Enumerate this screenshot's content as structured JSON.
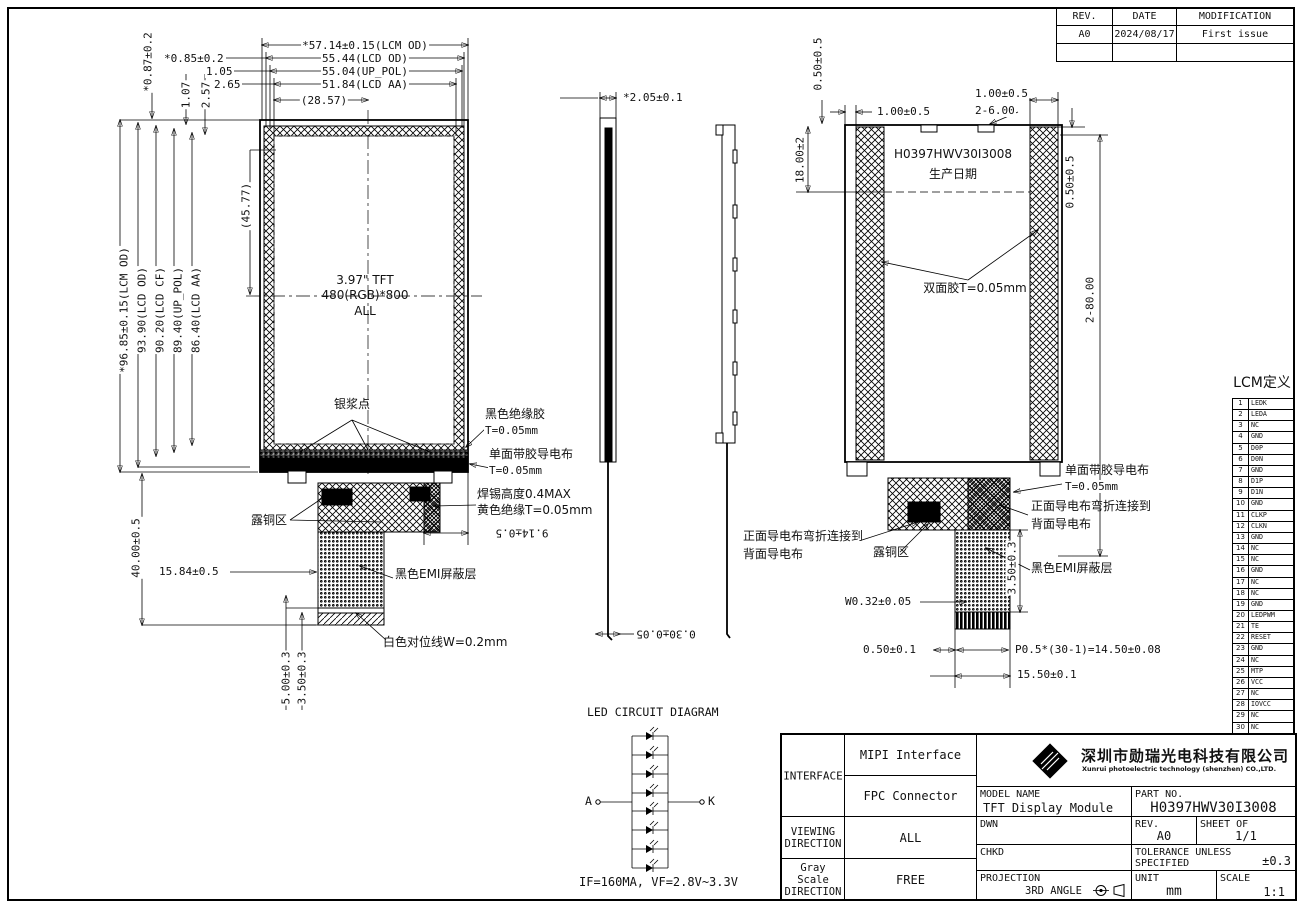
{
  "rev_table": {
    "col_rev": "REV.",
    "col_date": "DATE",
    "col_mod": "MODIFICATION",
    "rev": "A0",
    "date": "2024/08/17",
    "mod": "First issue"
  },
  "front_view": {
    "dims": {
      "w_lcm": "*57.14±0.15(LCM OD)",
      "w_lcd": "55.44(LCD OD)",
      "w_pol": "55.04(UP_POL)",
      "w_aa": "51.84(LCD AA)",
      "w_half": "(28.57)",
      "off1": "*0.85±0.2",
      "off2": "1.05",
      "off3": "2.65",
      "voff1": "*0.87±0.2",
      "voff2": "1.07",
      "voff3": "2.57",
      "h_lcm": "*96.85±0.15(LCM OD)",
      "h_lcd": "93.90(LCD OD)",
      "h_cf": "90.20(LCD CF)",
      "h_pol": "89.40(UP_POL)",
      "h_aa": "86.40(LCD AA)",
      "h_half": "(45.77)",
      "fpc_len": "40.00±0.5",
      "fpc_off": "15.84±0.5",
      "fpc_w": "9.14±0.5",
      "tail_a": "5.00±0.3",
      "tail_b": "3.50±0.3"
    },
    "screen": {
      "line1": "3.97\" TFT",
      "line2": "480(RGB)*800",
      "line3": "ALL"
    },
    "labels": {
      "silver": "银浆点",
      "glue1": "黑色绝缘胶",
      "glue2": "T=0.05mm",
      "cloth1": "单面带胶导电布",
      "cloth2": "T=0.05mm",
      "solder1": "焊锡高度0.4MAX",
      "solder2": "黄色绝缘T=0.05mm",
      "copper": "露铜区",
      "emi": "黑色EMI屏蔽层",
      "align": "白色对位线W=0.2mm"
    }
  },
  "side_view": {
    "thickness": "*2.05±0.1",
    "fpc_t": "0.30±0.05"
  },
  "rear_view": {
    "dims": {
      "gap_tl": "0.50±0.5",
      "tape_l": "1.00±0.5",
      "tape_r": "1.00±0.5",
      "notch": "2-6.00",
      "date_h": "18.00±2",
      "gap_tr": "0.50±0.5",
      "tape_len": "2-80.00",
      "emi_h": "3.50±0.3",
      "trace": "W0.32±0.05",
      "pad": "0.50±0.1",
      "pitch": "P0.5*(30-1)=14.50±0.08",
      "fpc_w": "15.50±0.1"
    },
    "marking": {
      "part": "H0397HWV30I3008",
      "date": "生产日期"
    },
    "labels": {
      "tape": "双面胶T=0.05mm",
      "cloth1": "单面带胶导电布",
      "cloth2": "T=0.05mm",
      "fold1a": "正面导电布弯折连接到",
      "fold1b": "背面导电布",
      "fold2a": "正面导电布弯折连接到",
      "fold2b": "背面导电布",
      "copper": "露铜区",
      "emi": "黑色EMI屏蔽层"
    }
  },
  "pin_table": {
    "title": "LCM定义",
    "rows": [
      {
        "no": "1",
        "name": "LEDK"
      },
      {
        "no": "2",
        "name": "LEDA"
      },
      {
        "no": "3",
        "name": "NC"
      },
      {
        "no": "4",
        "name": "GND"
      },
      {
        "no": "5",
        "name": "D0P"
      },
      {
        "no": "6",
        "name": "D0N"
      },
      {
        "no": "7",
        "name": "GND"
      },
      {
        "no": "8",
        "name": "D1P"
      },
      {
        "no": "9",
        "name": "D1N"
      },
      {
        "no": "10",
        "name": "GND"
      },
      {
        "no": "11",
        "name": "CLKP"
      },
      {
        "no": "12",
        "name": "CLKN"
      },
      {
        "no": "13",
        "name": "GND"
      },
      {
        "no": "14",
        "name": "NC"
      },
      {
        "no": "15",
        "name": "NC"
      },
      {
        "no": "16",
        "name": "GND"
      },
      {
        "no": "17",
        "name": "NC"
      },
      {
        "no": "18",
        "name": "NC"
      },
      {
        "no": "19",
        "name": "GND"
      },
      {
        "no": "20",
        "name": "LEDPWM"
      },
      {
        "no": "21",
        "name": "TE"
      },
      {
        "no": "22",
        "name": "RESET"
      },
      {
        "no": "23",
        "name": "GND"
      },
      {
        "no": "24",
        "name": "NC"
      },
      {
        "no": "25",
        "name": "MTP"
      },
      {
        "no": "26",
        "name": "VCC"
      },
      {
        "no": "27",
        "name": "NC"
      },
      {
        "no": "28",
        "name": "IOVCC"
      },
      {
        "no": "29",
        "name": "NC"
      },
      {
        "no": "30",
        "name": "NC"
      }
    ]
  },
  "notes": {
    "lines": [
      "NOTES:",
      "1. DISPLAY TYPE: 3.97'' INCH TFT",
      "2. BACKLIGHT: 8 CHIP WHITE LED, IN PARALLEL",
      "3. OPERATING TEMP: -20° C~+70° C",
      "4. STORAGE TEMP: -30° c~+80° c",
      "5. RESOLUTION: 480xRGBx800",
      "6. Luminous instensity(Center):Module:320cd/m2(MIN.),400cd/m2(TYP.)",
      "   Chromaticity:X=0.29±0.03,Y=0.30±0.03",
      "7. Uniformity:80%(Min)",
      "8. LCD IC:ST7701S",
      "9. \"( )\"reference dimension. \"*\"critical dimension",
      "10. RoHs Compliant"
    ]
  },
  "led": {
    "title": "LED CIRCUIT DIAGRAM",
    "a": "A",
    "k": "K",
    "spec": "IF=160MA, VF=2.8V~3.3V"
  },
  "title_block": {
    "interface_label": "INTERFACE",
    "interface_v1": "MIPI Interface",
    "interface_v2": "FPC Connector",
    "viewing_label": "VIEWING DIRECTION",
    "viewing_value": "ALL",
    "gray_label": "Gray Scale DIRECTION",
    "gray_value": "FREE",
    "company_cn": "深圳市勋瑞光电科技有限公司",
    "company_en": "Xunrui photoelectric technology (shenzhen) CO.,LTD.",
    "model_label": "MODEL NAME",
    "model_value": "TFT Display Module",
    "part_label": "PART NO.",
    "part_value": "H0397HWV30I3008",
    "dwn_label": "DWN",
    "rev_label": "REV.",
    "rev_value": "A0",
    "sheet_label": "SHEET OF",
    "sheet_value": "1/1",
    "chkd_label": "CHKD",
    "tol_label": "TOLERANCE UNLESS SPECIFIED",
    "tol_value": "±0.3",
    "proj_label": "PROJECTION",
    "proj_value": "3RD ANGLE",
    "unit_label": "UNIT",
    "unit_value": "mm",
    "scale_label": "SCALE",
    "scale_value": "1:1"
  }
}
